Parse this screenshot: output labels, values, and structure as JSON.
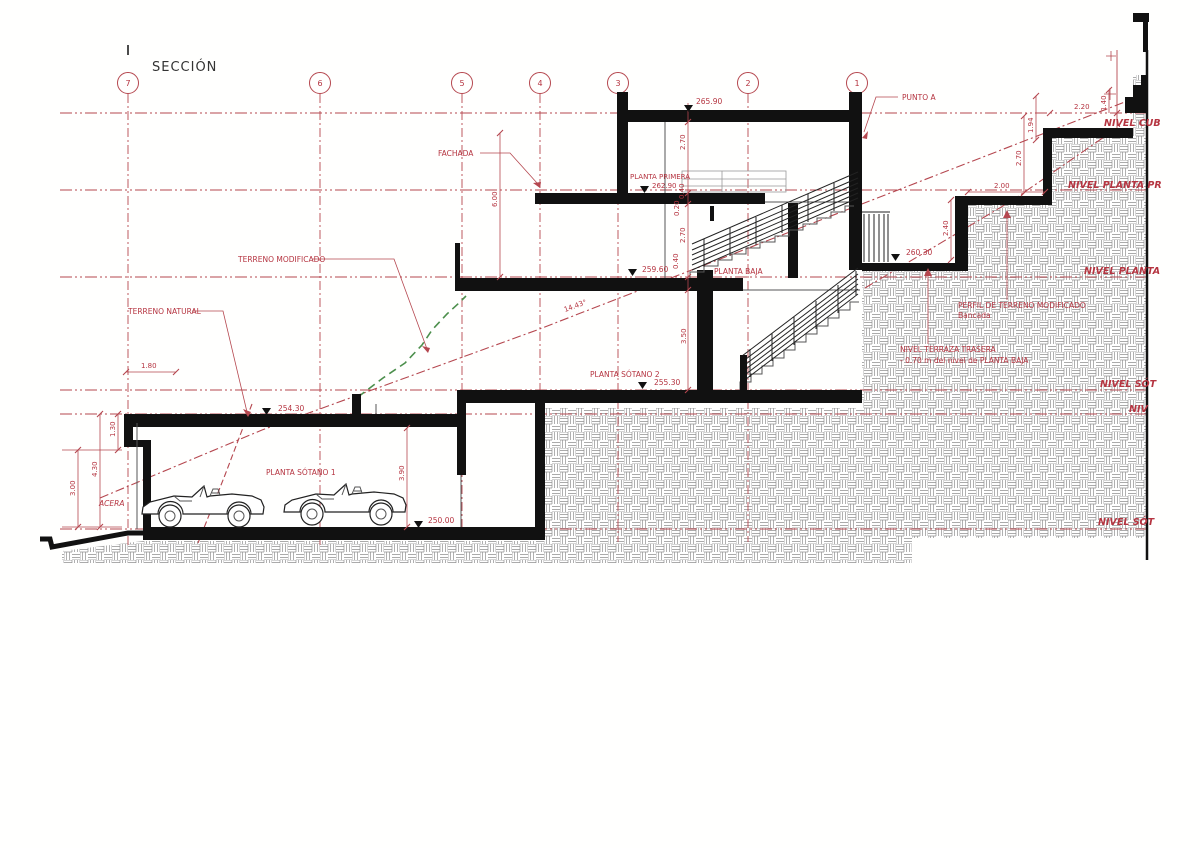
{
  "title": "SECCIÓN",
  "grid_bubbles": [
    "7",
    "6",
    "5",
    "4",
    "3",
    "2",
    "1"
  ],
  "room_labels": {
    "planta_primera": "PLANTA PRIMERA",
    "planta_baja": "PLANTA BAJA",
    "planta_sotano_1": "PLANTA SÓTANO 1",
    "planta_sotano_2": "PLANTA SÓTANO 2",
    "acera": "ACERA"
  },
  "callouts": {
    "punto_a": "PUNTO A",
    "fachada": "FACHADA",
    "terreno_natural": "TERRENO NATURAL",
    "terreno_modificado": "TERRENO MODIFICADO",
    "perfil_terreno_1": "PERFIL DE TERRENO MODIFICADO",
    "perfil_terreno_2": "Bancada",
    "nivel_terraza_1": "NIVEL TERRAZA TRASERA",
    "nivel_terraza_2": "- 0.70 m del nivel de PLANTA BAJA"
  },
  "level_labels": {
    "cubierta": "NIVEL CUB",
    "planta_primera": "NIVEL PLANTA PR",
    "planta_baja": "NIVEL PLANTA",
    "sotano_2": "NIVEL SÓT",
    "intermedio": "NIV",
    "sotano_1": "NIVEL SÓT"
  },
  "elevations": {
    "cubierta": "265.90",
    "planta_primera": "262.90",
    "planta_baja": "259.60",
    "terraza": "260.30",
    "sotano_2": "255.30",
    "terreno": "254.30",
    "sotano_1": "250.00"
  },
  "dims": {
    "chain": [
      "2.70",
      "0.40",
      "0.20",
      "2.70",
      "0.40",
      "3.50"
    ],
    "fachada_h": "6.00",
    "garaje_h": "3.90",
    "ancho_izq": "1.80",
    "izq_130": "1.30",
    "izq_430": "4.30",
    "izq_300": "3.00",
    "der_240": "2.40",
    "der_200": "2.00",
    "der_270": "2.70",
    "der_194": "1.94",
    "der_220": "2.20",
    "der_140": "1.40",
    "pendiente": "14.43°"
  }
}
